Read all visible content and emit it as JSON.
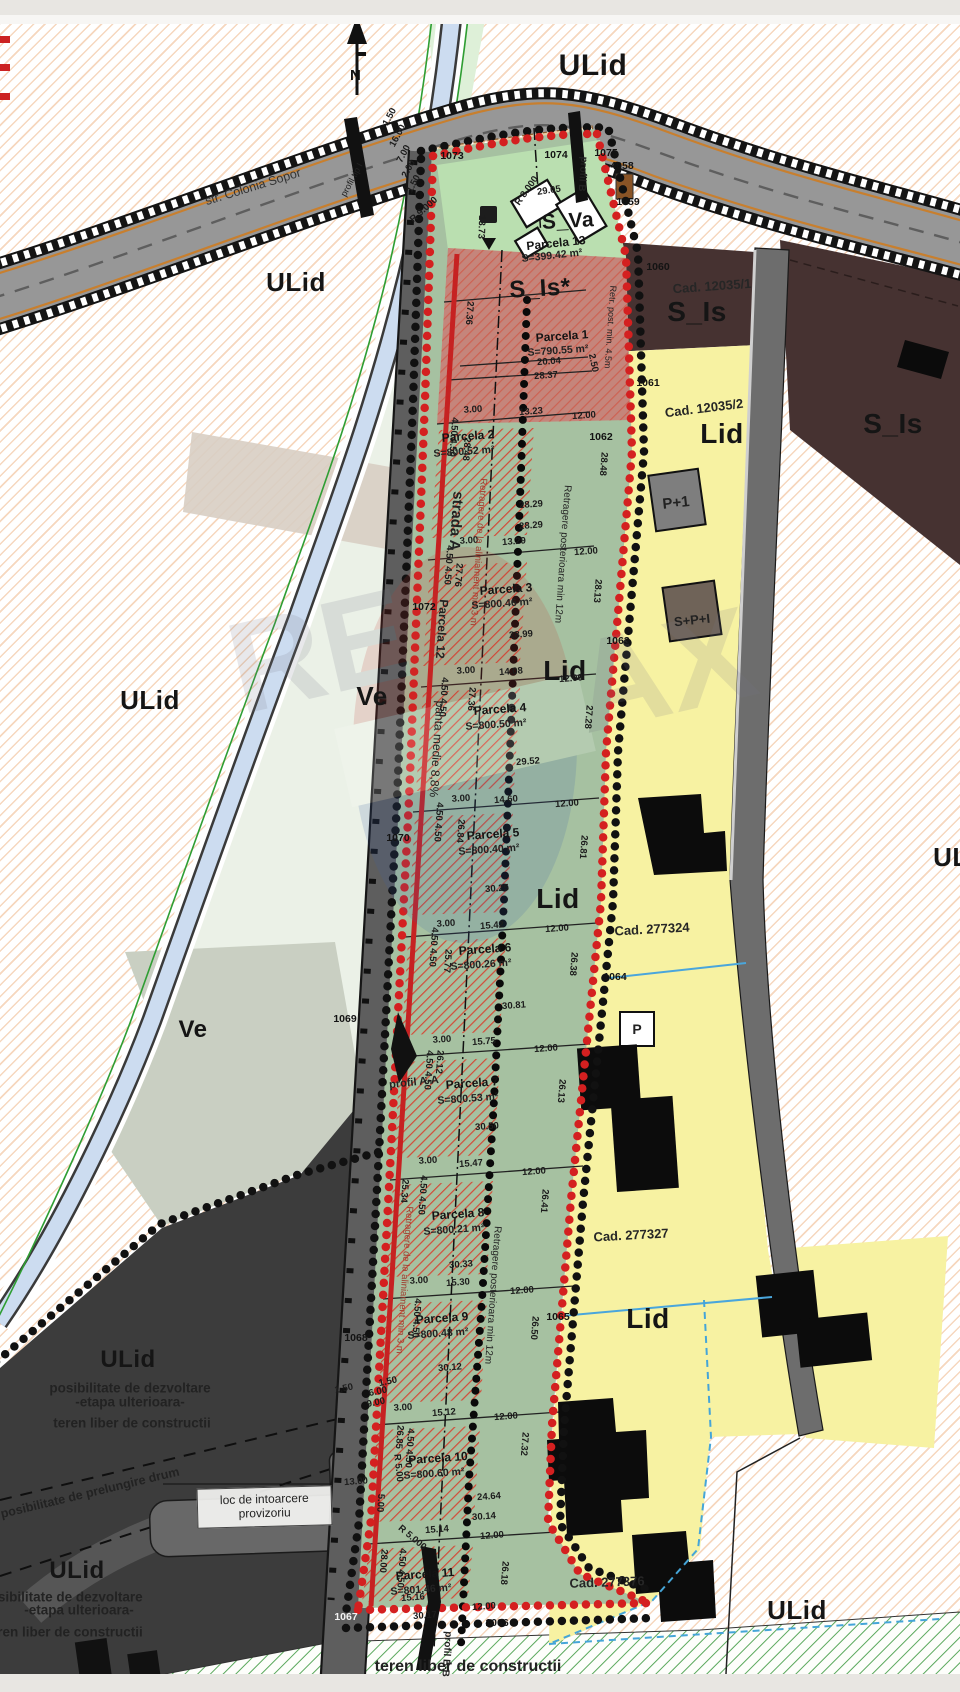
{
  "compass": "N",
  "colors": {
    "puz_boundary_red": "#c62222",
    "boundary_black": "#111111",
    "zone_yellow": "#f7f2a2",
    "zone_green": "#a6c1a1",
    "zone_brown": "#463231",
    "zone_dark_gray": "#3c3c3c",
    "hatch_orange": "#e79655",
    "river_blue": "#ccdcf0",
    "road_gray": "#979797",
    "red_hatch": "#d34b38"
  },
  "loc_box": {
    "line1": "loc de intoarcere",
    "line2": "provizoriu"
  },
  "zones": [
    [
      "ULid",
      593,
      66,
      0,
      30,
      1
    ],
    [
      "ULid",
      296,
      282,
      0,
      26,
      1
    ],
    [
      "ULid",
      150,
      700,
      0,
      26,
      1
    ],
    [
      "ULid",
      963,
      857,
      0,
      26,
      1
    ],
    [
      "ULid",
      797,
      1610,
      0,
      26,
      1
    ],
    [
      "ULid",
      128,
      1360,
      0,
      24,
      1
    ],
    [
      "ULid",
      77,
      1571,
      0,
      24,
      1
    ],
    [
      "Ve",
      372,
      696,
      0,
      26,
      1
    ],
    [
      "Ve",
      193,
      1030,
      0,
      24,
      1
    ],
    [
      "S_Is",
      697,
      312,
      0,
      28,
      1
    ],
    [
      "S_Is",
      893,
      424,
      0,
      28,
      1
    ],
    [
      "S_Is*",
      540,
      289,
      -3,
      24,
      1
    ],
    [
      "Lid",
      722,
      434,
      0,
      28,
      1
    ],
    [
      "Lid",
      565,
      671,
      0,
      28,
      1
    ],
    [
      "Lid",
      558,
      899,
      0,
      28,
      1
    ],
    [
      "Lid",
      648,
      1319,
      0,
      28,
      1
    ],
    [
      "S_Va",
      568,
      221,
      -3,
      21,
      1
    ]
  ],
  "cads": [
    [
      "Cad. 12035/1",
      712,
      286,
      -4
    ],
    [
      "Cad. 12035/2",
      704,
      408,
      -7
    ],
    [
      "Cad. 277324",
      652,
      929,
      -3
    ],
    [
      "Cad. 277327",
      631,
      1235,
      -3
    ],
    [
      "Cad. 277376",
      607,
      1582,
      -2
    ]
  ],
  "parcels": [
    {
      "n": "Parcela 13",
      "a": "S=399.42 m²",
      "x": 556,
      "y": 243,
      "ay": 256,
      "r": -6
    },
    {
      "n": "Parcela 1",
      "a": "S=790.55 m²",
      "x": 562,
      "y": 336,
      "ay": 351,
      "r": -4
    },
    {
      "n": "Parcela 2",
      "a": "S=800.52 m²",
      "x": 468,
      "y": 436,
      "ay": 452,
      "r": -4
    },
    {
      "n": "Parcela 3",
      "a": "S=800.46 m²",
      "x": 506,
      "y": 589,
      "ay": 604,
      "r": -4
    },
    {
      "n": "Parcela 4",
      "a": "S=800.50 m²",
      "x": 500,
      "y": 709,
      "ay": 725,
      "r": -4
    },
    {
      "n": "Parcela 5",
      "a": "S=800.40 m²",
      "x": 493,
      "y": 834,
      "ay": 850,
      "r": -4
    },
    {
      "n": "Parcela 6",
      "a": "S=800.26 m²",
      "x": 485,
      "y": 949,
      "ay": 965,
      "r": -4
    },
    {
      "n": "Parcela 7",
      "a": "S=800.53 m²",
      "x": 472,
      "y": 1083,
      "ay": 1099,
      "r": -4
    },
    {
      "n": "Parcela 8",
      "a": "S=800.21 m²",
      "x": 458,
      "y": 1214,
      "ay": 1230,
      "r": -4
    },
    {
      "n": "Parcela 9",
      "a": "S=800.48 m²",
      "x": 442,
      "y": 1318,
      "ay": 1334,
      "r": -4
    },
    {
      "n": "Parcela 10",
      "a": "S=800.60 m²",
      "x": 438,
      "y": 1458,
      "ay": 1474,
      "r": -4
    },
    {
      "n": "Parcela 11",
      "a": "S=801.46 m²",
      "x": 425,
      "y": 1574,
      "ay": 1590,
      "r": -4
    }
  ],
  "buildings": [
    [
      "P+1",
      676,
      503,
      -6,
      15,
      1
    ],
    [
      "S+P+I",
      692,
      620,
      -6,
      13,
      1
    ],
    [
      "P",
      637,
      1029,
      0,
      14,
      1
    ]
  ],
  "markers": [
    [
      "1073",
      452,
      156
    ],
    [
      "1074",
      556,
      155
    ],
    [
      "1075",
      606,
      153
    ],
    [
      "4058",
      622,
      166
    ],
    [
      "1059",
      628,
      202
    ],
    [
      "1060",
      658,
      267
    ],
    [
      "1061",
      648,
      383
    ],
    [
      "1062",
      601,
      437
    ],
    [
      "1063",
      618,
      641
    ],
    [
      "1064",
      615,
      977
    ],
    [
      "1065",
      558,
      1317
    ],
    [
      "1066",
      497,
      1623
    ],
    [
      "1067",
      346,
      1617,
      0,
      0,
      0,
      "#f2f2f2"
    ],
    [
      "1068",
      356,
      1338
    ],
    [
      "1069",
      345,
      1019
    ],
    [
      "1070",
      398,
      838
    ],
    [
      "1072",
      424,
      607
    ]
  ],
  "dims": [
    [
      "1.50",
      390,
      117,
      -62
    ],
    [
      "16.00",
      398,
      136,
      -62
    ],
    [
      "7.00",
      404,
      154,
      -62
    ],
    [
      "2.00",
      409,
      169,
      -62
    ],
    [
      "1.50",
      414,
      184,
      -62
    ],
    [
      "R 9.000",
      424,
      210,
      -42
    ],
    [
      "R 8.000",
      527,
      191,
      -55
    ],
    [
      "29.05",
      549,
      191,
      -8
    ],
    [
      "13.73",
      481,
      227,
      92
    ],
    [
      "20.04",
      549,
      362,
      -4
    ],
    [
      "28.37",
      546,
      376,
      -4
    ],
    [
      "2.50",
      593,
      363,
      78
    ],
    [
      "27.36",
      469,
      313,
      94
    ],
    [
      "3.00",
      473,
      410,
      -4
    ],
    [
      "13.23",
      531,
      412,
      -4
    ],
    [
      "12.00",
      584,
      416,
      -4
    ],
    [
      "4.50 4.50",
      453,
      437,
      94
    ],
    [
      "28.29",
      531,
      505,
      -4
    ],
    [
      "28.29",
      531,
      526,
      -4
    ],
    [
      "28.48",
      466,
      449,
      94
    ],
    [
      "28.48",
      603,
      464,
      94
    ],
    [
      "3.00",
      469,
      541,
      -4
    ],
    [
      "13.29",
      514,
      542,
      -4
    ],
    [
      "12.00",
      586,
      552,
      -4
    ],
    [
      "28.13",
      597,
      591,
      94
    ],
    [
      "27.76",
      458,
      575,
      94
    ],
    [
      "4.50 4.50",
      448,
      565,
      94
    ],
    [
      "28.99",
      521,
      635,
      -4
    ],
    [
      "3.00",
      466,
      671,
      -4
    ],
    [
      "14.08",
      511,
      672,
      -4
    ],
    [
      "12.00",
      571,
      679,
      -4
    ],
    [
      "27.36",
      471,
      699,
      94
    ],
    [
      "27.28",
      588,
      717,
      94
    ],
    [
      "4.50 4.50",
      443,
      697,
      94
    ],
    [
      "29.52",
      528,
      762,
      -4
    ],
    [
      "3.00",
      461,
      799,
      -4
    ],
    [
      "14.60",
      506,
      800,
      -4
    ],
    [
      "12.00",
      567,
      804,
      -4
    ],
    [
      "26.84",
      460,
      831,
      94
    ],
    [
      "26.81",
      583,
      847,
      94
    ],
    [
      "4.50 4.50",
      438,
      822,
      94
    ],
    [
      "30.25",
      497,
      889,
      -4
    ],
    [
      "3.00",
      446,
      924,
      -4
    ],
    [
      "15.42",
      492,
      926,
      -4
    ],
    [
      "12.00",
      557,
      929,
      -4
    ],
    [
      "25.77",
      447,
      961,
      94
    ],
    [
      "26.38",
      573,
      964,
      94
    ],
    [
      "4.50 4.50",
      433,
      947,
      94
    ],
    [
      "30.81",
      514,
      1006,
      -4
    ],
    [
      "3.00",
      442,
      1040,
      -4
    ],
    [
      "15.75",
      484,
      1042,
      -4
    ],
    [
      "12.00",
      546,
      1049,
      -4
    ],
    [
      "26.12",
      439,
      1062,
      94
    ],
    [
      "26.13",
      561,
      1091,
      94
    ],
    [
      "4.50 4.50",
      428,
      1070,
      94
    ],
    [
      "30.50",
      487,
      1127,
      -4
    ],
    [
      "3.00",
      428,
      1161,
      -4
    ],
    [
      "15.47",
      471,
      1164,
      -4
    ],
    [
      "12.00",
      534,
      1172,
      -4
    ],
    [
      "25.34",
      404,
      1191,
      94
    ],
    [
      "26.41",
      544,
      1201,
      94
    ],
    [
      "4.50 4.50",
      422,
      1195,
      94
    ],
    [
      "30.33",
      461,
      1265,
      -4
    ],
    [
      "3.00",
      419,
      1281,
      -4
    ],
    [
      "15.30",
      458,
      1283,
      -4
    ],
    [
      "12.00",
      522,
      1291,
      -4
    ],
    [
      "26.50",
      534,
      1328,
      94
    ],
    [
      "4.50 4.50",
      416,
      1318,
      94
    ],
    [
      "30.12",
      450,
      1368,
      -4
    ],
    [
      "3.00",
      403,
      1408,
      -4
    ],
    [
      "15.12",
      444,
      1413,
      -4
    ],
    [
      "12.00",
      506,
      1417,
      -4
    ],
    [
      "26.85",
      399,
      1437,
      94
    ],
    [
      "27.32",
      524,
      1444,
      94
    ],
    [
      "4.50 4.50",
      409,
      1448,
      94
    ],
    [
      "24.64",
      489,
      1497,
      -4
    ],
    [
      "30.14",
      484,
      1517,
      -4
    ],
    [
      "15.14",
      437,
      1530,
      -4
    ],
    [
      "12.00",
      492,
      1536,
      -4
    ],
    [
      "5.00",
      380,
      1503,
      94
    ],
    [
      "28.00",
      383,
      1561,
      94
    ],
    [
      "26.18",
      504,
      1573,
      94
    ],
    [
      "4.50 4.50",
      401,
      1568,
      94
    ],
    [
      "15.16",
      413,
      1598,
      -4
    ],
    [
      "30.17",
      425,
      1616,
      -4
    ],
    [
      "12.00",
      484,
      1607,
      -4
    ],
    [
      "13.00",
      356,
      1482,
      -4
    ],
    [
      "R 5.00",
      398,
      1468,
      84
    ],
    [
      "R 5.000",
      412,
      1538,
      40
    ],
    [
      "1.50",
      344,
      1389,
      -12
    ],
    [
      "6.00",
      378,
      1392,
      -12
    ],
    [
      "9.00",
      376,
      1403,
      -12
    ],
    [
      "1.50",
      388,
      1382,
      -12
    ]
  ],
  "notes": [
    [
      "str. Colonia Sopor",
      253,
      187,
      -17,
      12.5,
      0,
      "#333333"
    ],
    [
      "profil tip I",
      352,
      180,
      -62,
      9
    ],
    [
      "strada A",
      456,
      521,
      94,
      15,
      1
    ],
    [
      "Parcela 12",
      442,
      629,
      94,
      12,
      1
    ],
    [
      "panta medie 8,8%",
      437,
      749,
      94,
      12
    ],
    [
      "Retragere de la aliniament min 3 m",
      478,
      552,
      94,
      9.5,
      0,
      "#a13c2e"
    ],
    [
      "Retragere de la aliniament min 3 m",
      404,
      1280,
      94,
      9.5,
      0,
      "#a13c2e"
    ],
    [
      "Retragere posterioara min 12m",
      562,
      554,
      94,
      10
    ],
    [
      "Retragere posterioara min 12m",
      492,
      1295,
      94,
      10
    ],
    [
      "Retr. post. min. 4.5m",
      610,
      327,
      94,
      9
    ],
    [
      "profil A-A",
      414,
      1083,
      -6,
      11,
      1
    ],
    [
      "profil B-B",
      446,
      1654,
      94,
      10,
      1
    ],
    [
      "profil B",
      582,
      174,
      94,
      10,
      1
    ],
    [
      "posibilitate de prelungire drum",
      90,
      1493,
      -13.5,
      12.5,
      1
    ],
    [
      "posibilitate de dezvoltare",
      130,
      1388,
      0,
      13.5,
      1
    ],
    [
      "-etapa ulterioara-",
      130,
      1402,
      0,
      13.5,
      1
    ],
    [
      "teren liber de constructii",
      132,
      1423,
      0,
      13.5,
      1
    ],
    [
      "posibilitate de dezvoltare",
      62,
      1597,
      0,
      13.5,
      1
    ],
    [
      "-etapa ulterioara-",
      79,
      1610,
      0,
      13.5,
      1
    ],
    [
      "teren liber de constructii",
      64,
      1632,
      0,
      13.5,
      1
    ],
    [
      "teren liber de constructii",
      468,
      1667,
      0,
      16,
      1
    ]
  ]
}
